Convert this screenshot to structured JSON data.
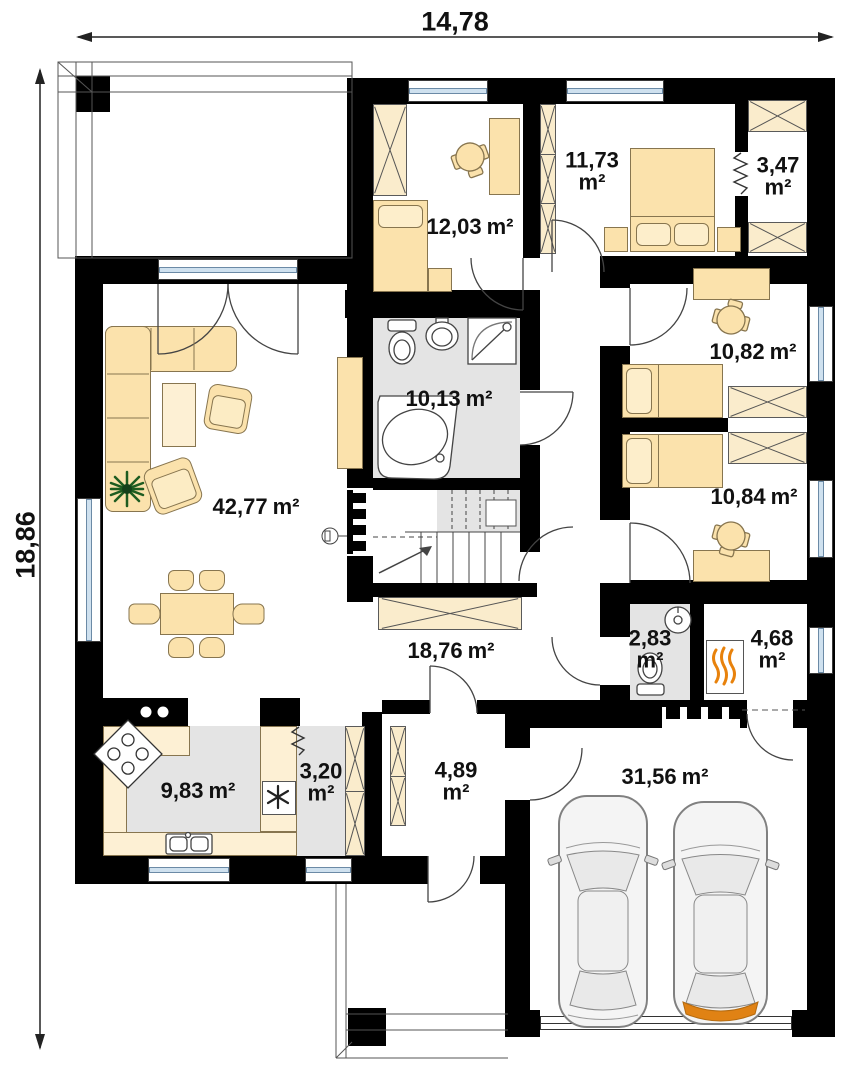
{
  "plan_title": "single-storey house floor plan",
  "dimensions": {
    "width": "14,78",
    "height": "18,86"
  },
  "rooms": [
    {
      "name": "bedroom-left",
      "value": "12,03",
      "unit": "m²",
      "layout": "inline"
    },
    {
      "name": "bedroom-main",
      "value": "11,73",
      "unit": "m²",
      "layout": "stacked"
    },
    {
      "name": "closet",
      "value": "3,47",
      "unit": "m²",
      "layout": "stacked"
    },
    {
      "name": "bedroom-top-right",
      "value": "10,82",
      "unit": "m²",
      "layout": "inline"
    },
    {
      "name": "bathroom",
      "value": "10,13",
      "unit": "m²",
      "layout": "inline"
    },
    {
      "name": "living-room",
      "value": "42,77",
      "unit": "m²",
      "layout": "inline"
    },
    {
      "name": "bedroom-bottom-right",
      "value": "10,84",
      "unit": "m²",
      "layout": "inline"
    },
    {
      "name": "hall",
      "value": "18,76",
      "unit": "m²",
      "layout": "inline"
    },
    {
      "name": "wc",
      "value": "2,83",
      "unit": "m²",
      "layout": "stacked"
    },
    {
      "name": "boiler-room",
      "value": "4,68",
      "unit": "m²",
      "layout": "stacked"
    },
    {
      "name": "kitchen",
      "value": "9,83",
      "unit": "m²",
      "layout": "inline"
    },
    {
      "name": "pantry",
      "value": "3,20",
      "unit": "m²",
      "layout": "stacked"
    },
    {
      "name": "vestibule",
      "value": "4,89",
      "unit": "m²",
      "layout": "stacked"
    },
    {
      "name": "garage",
      "value": "31,56",
      "unit": "m²",
      "layout": "inline"
    }
  ],
  "colors": {
    "wall": "#000000",
    "furniture": "#fbe2ac",
    "floor_tile": "#e4e4e4",
    "window_glass": "#cfe1ef",
    "flame": "#e8820c",
    "car_accent": "#e08214",
    "plant": "#2e7d32",
    "label": "#111111"
  }
}
